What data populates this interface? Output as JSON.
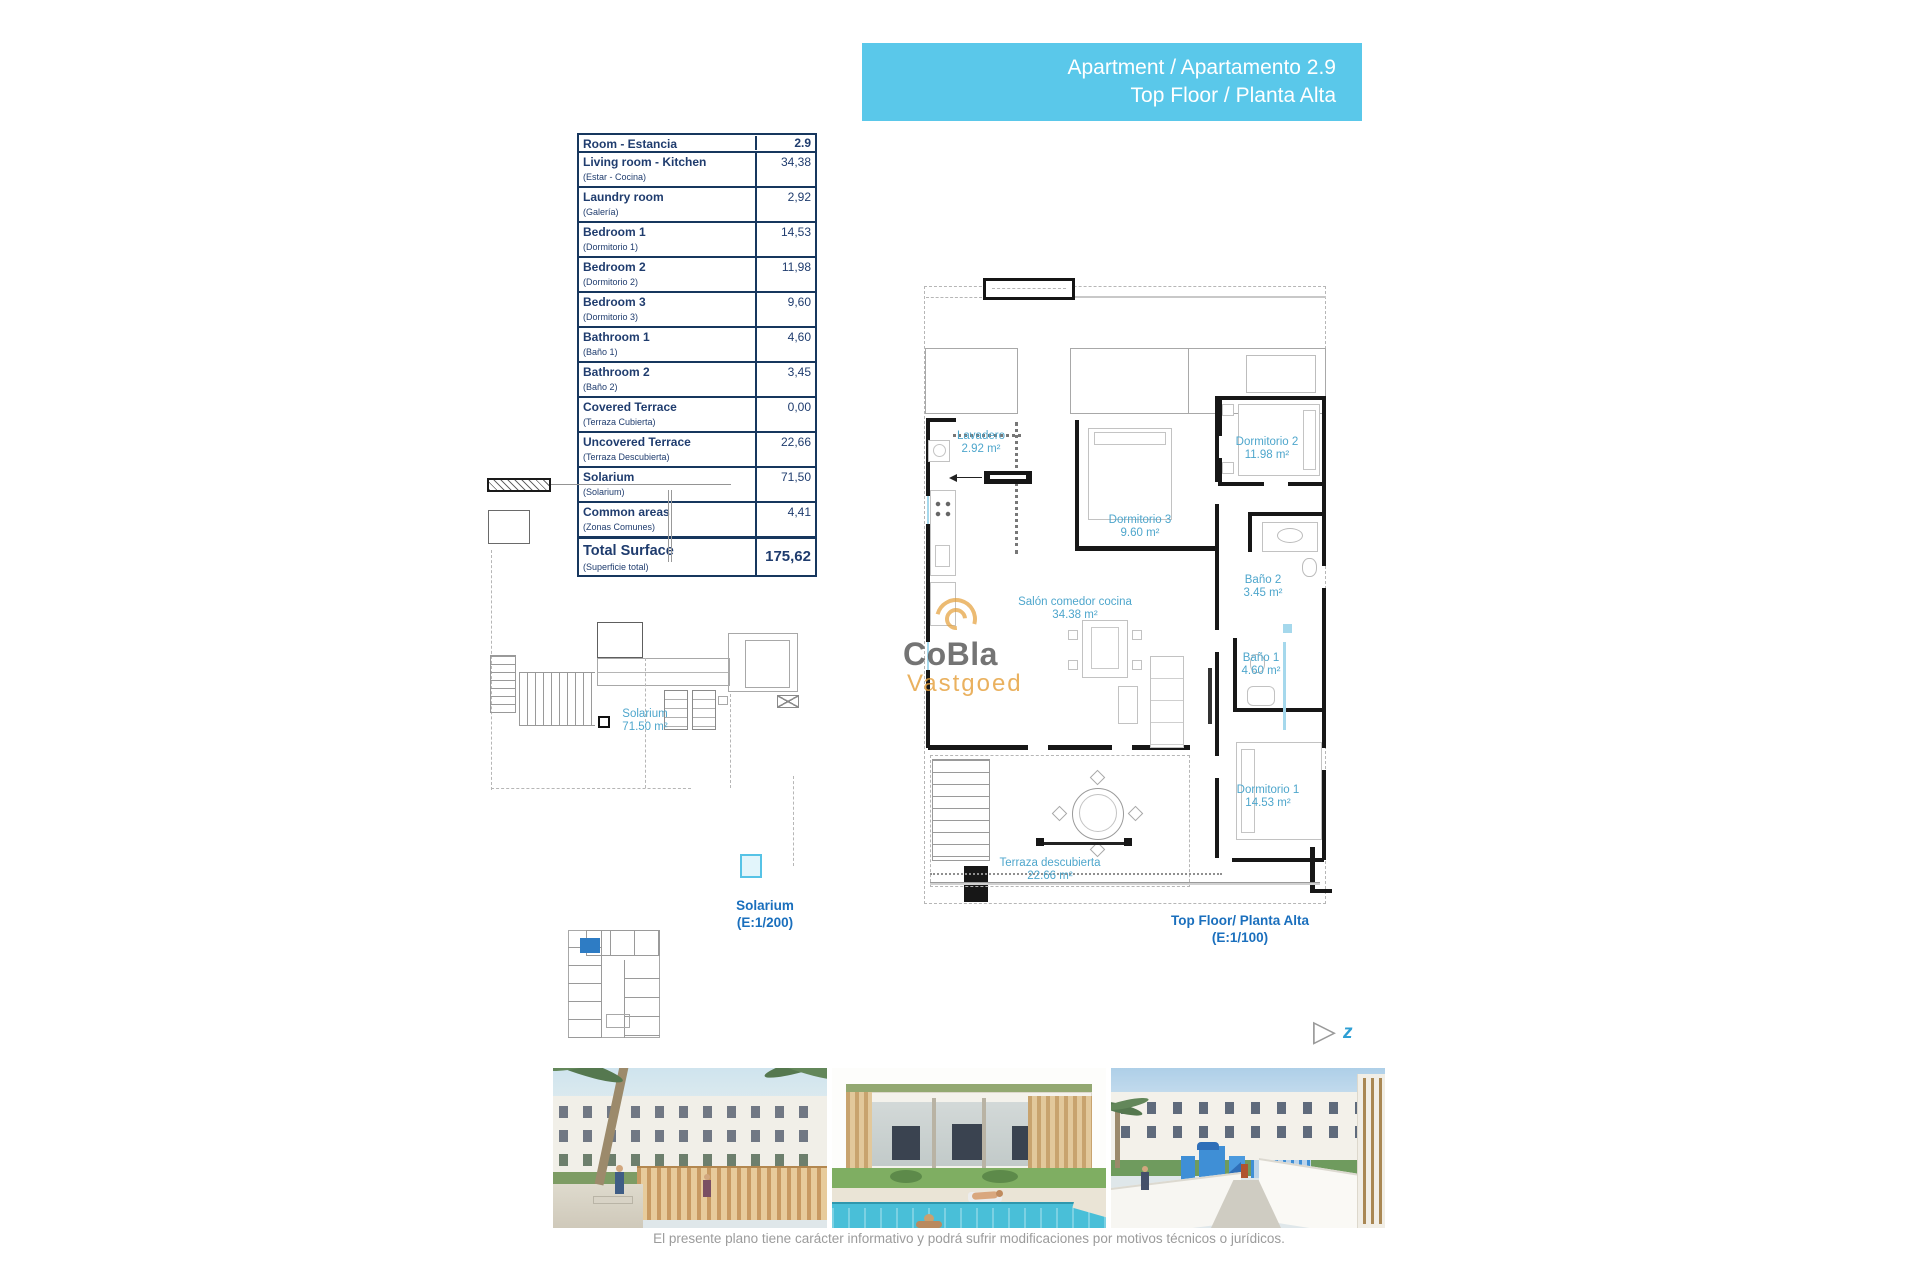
{
  "banner": {
    "line1": "Apartment / Apartamento 2.9",
    "line2": "Top Floor / Planta Alta"
  },
  "table": {
    "header": {
      "label": "Room - Estancia",
      "value": "2.9"
    },
    "rows": [
      {
        "label": "Living room - Kitchen",
        "sub": "(Estar - Cocina)",
        "value": "34,38"
      },
      {
        "label": "Laundry room",
        "sub": "(Galería)",
        "value": "2,92"
      },
      {
        "label": "Bedroom 1",
        "sub": "(Dormitorio 1)",
        "value": "14,53"
      },
      {
        "label": "Bedroom 2",
        "sub": "(Dormitorio 2)",
        "value": "11,98"
      },
      {
        "label": "Bedroom 3",
        "sub": "(Dormitorio 3)",
        "value": "9,60"
      },
      {
        "label": "Bathroom 1",
        "sub": "(Baño 1)",
        "value": "4,60"
      },
      {
        "label": "Bathroom 2",
        "sub": "(Baño 2)",
        "value": "3,45"
      },
      {
        "label": "Covered Terrace",
        "sub": "(Terraza Cubierta)",
        "value": "0,00"
      },
      {
        "label": "Uncovered Terrace",
        "sub": "(Terraza Descubierta)",
        "value": "22,66"
      },
      {
        "label": "Solarium",
        "sub": "(Solarium)",
        "value": "71,50"
      },
      {
        "label": "Common areas",
        "sub": "(Zonas Comunes)",
        "value": "4,41"
      }
    ],
    "total": {
      "label": "Total Surface",
      "sub": "(Superficie total)",
      "value": "175,62"
    }
  },
  "main_plan": {
    "caption": "Top Floor/ Planta Alta (E:1/100)",
    "rooms": [
      {
        "name": "Lavadero",
        "area": "2.92 m²"
      },
      {
        "name": "Dormitorio 2",
        "area": "11.98 m²"
      },
      {
        "name": "Dormitorio 3",
        "area": "9.60 m²"
      },
      {
        "name": "Baño 2",
        "area": "3.45 m²"
      },
      {
        "name": "Salón comedor cocina",
        "area": "34.38 m²"
      },
      {
        "name": "Baño 1",
        "area": "4.60 m²"
      },
      {
        "name": "Dormitorio 1",
        "area": "14.53 m²"
      },
      {
        "name": "Terraza descubierta",
        "area": "22.66 m²"
      }
    ]
  },
  "solarium_plan": {
    "room": {
      "name": "Solarium",
      "area": "71.50 m²"
    },
    "caption_line1": "Solarium",
    "caption_line2": "(E:1/200)"
  },
  "logo": {
    "name": "CoBla",
    "suffix": "Vastgoed"
  },
  "compass": {
    "label": "z"
  },
  "disclaimer": "El presente plano tiene carácter informativo y podrá sufrir modificaciones por motivos técnicos o jurídicos.",
  "colors": {
    "banner": "#5ac8ea",
    "table_navy": "#1f3c6e",
    "plan_label_blue": "#4ea6cc",
    "caption_blue": "#1a6fbd",
    "logo_orange": "#e5a13e",
    "logo_gray": "#4a4a4a",
    "highlighted_unit": "#2e7cc4",
    "wall_black": "#171717"
  }
}
